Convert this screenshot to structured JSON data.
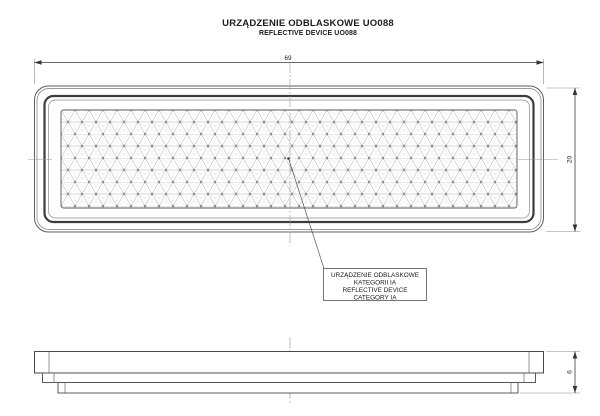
{
  "title": {
    "primary": "URZĄDZENIE ODBLASKOWE UO088",
    "secondary": "REFLECTIVE DEVICE UO088"
  },
  "dimensions": {
    "width_mm": "69",
    "height_mm": "20",
    "thickness_mm": "6"
  },
  "callout": {
    "line1": "URZĄDZENIE ODBLASKOWE",
    "line2": "KATEGORII IA",
    "line3": "REFLECTIVE DEVICE",
    "line4": "CATEGORY IA"
  },
  "colors": {
    "outline": "#4a4a4a",
    "bezel": "#3c3c3c",
    "dimension": "#555555",
    "pattern_line": "#a8a8a8",
    "centerline": "#9a9a9a",
    "background": "#ffffff"
  }
}
